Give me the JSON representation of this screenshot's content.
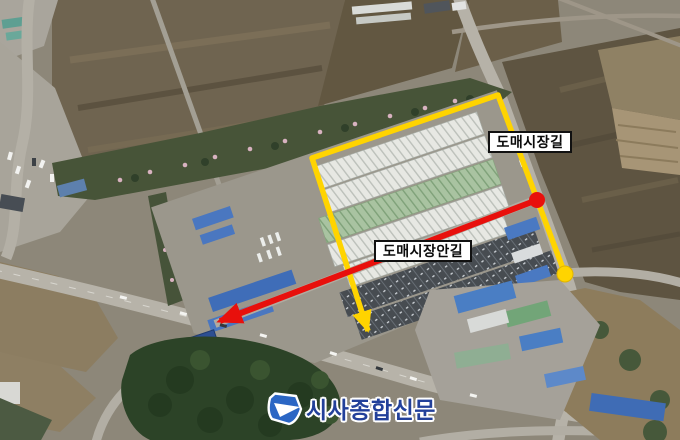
{
  "annotations": {
    "road_labels": [
      {
        "id": "outer-road",
        "text": "도매시장길"
      },
      {
        "id": "inner-road",
        "text": "도매시장안길"
      }
    ]
  },
  "watermark": {
    "publisher": "시사종합신문"
  },
  "colors": {
    "route_yellow": "#FFD400",
    "route_red": "#E8100C",
    "label_bg": "#FFFFFF",
    "label_border": "#111111",
    "label_text": "#0A0A0A",
    "watermark_text": "#22409A",
    "watermark_icon": "#2B66C4",
    "watermark_outline": "#FFFFFF"
  }
}
